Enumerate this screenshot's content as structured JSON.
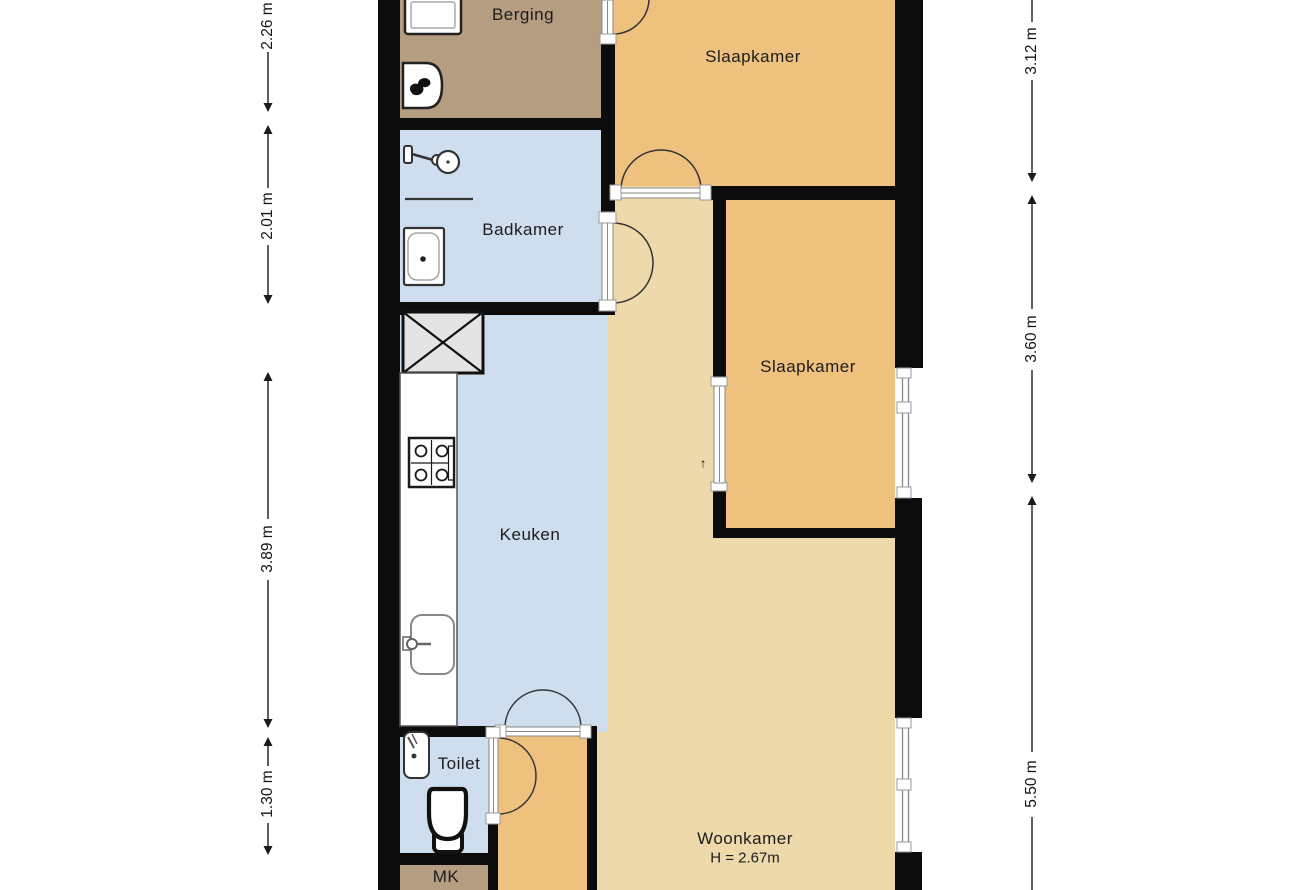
{
  "floorplan": {
    "rooms": [
      {
        "name": "berging",
        "label": "Berging"
      },
      {
        "name": "slaapkamer-top",
        "label": "Slaapkamer"
      },
      {
        "name": "badkamer",
        "label": "Badkamer"
      },
      {
        "name": "slaapkamer-mid",
        "label": "Slaapkamer"
      },
      {
        "name": "keuken",
        "label": "Keuken"
      },
      {
        "name": "toilet",
        "label": "Toilet"
      },
      {
        "name": "woonkamer",
        "label": "Woonkamer",
        "ceiling_height": "H = 2.67m"
      },
      {
        "name": "meterkast",
        "label": "MK"
      }
    ],
    "dimensions": {
      "left": [
        "2.26 m",
        "2.01 m",
        "3.89 m",
        "1.30 m"
      ],
      "right": [
        "3.12 m",
        "3.60 m",
        "5.50 m"
      ]
    },
    "sliding_door_marker": "↑",
    "fixtures": [
      "washing-machine",
      "boiler",
      "shower",
      "washbasin",
      "ventilation-shaft",
      "kitchen-counter",
      "stove",
      "kitchen-sink",
      "hand-basin",
      "toilet-bowl"
    ],
    "colors": {
      "wall": "#0c0c0c",
      "bedroom_floor": "#eec27e",
      "living_floor": "#edd9a9",
      "storage_floor": "#b59d81",
      "wet_floor": "#cfdeee",
      "shaft_fill": "#e4e4e4",
      "background": "#ffffff"
    }
  }
}
